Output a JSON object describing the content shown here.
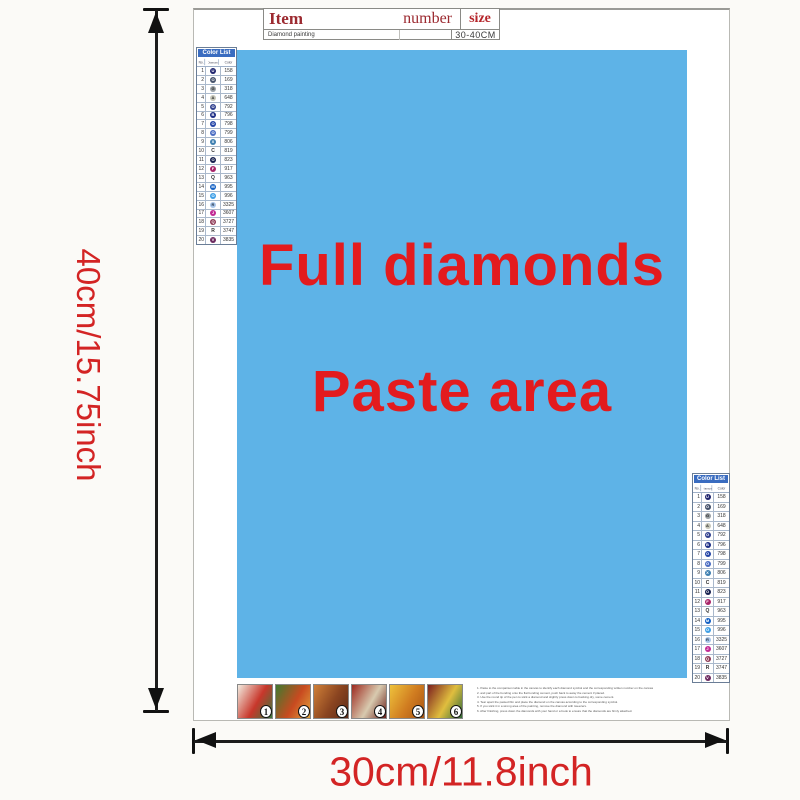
{
  "colors": {
    "paste_bg": "#5eb3e7",
    "paste_text": "#e31b1e",
    "dimension_text": "#d32424",
    "item_header_text": "#9c2a30",
    "color_list_header_bg": "#3a6cc0"
  },
  "dimension_labels": {
    "height": "40cm/15.75inch",
    "width": "30cm/11.8inch"
  },
  "item_table": {
    "col_item": "Item",
    "col_number": "number",
    "col_size": "size",
    "row_item": "Diamond painting",
    "row_number": "",
    "row_size": "30-40CM"
  },
  "paste_area": {
    "line1": "Full diamonds",
    "line2": "Paste area"
  },
  "color_list": {
    "title": "Color List",
    "columns": [
      "No.",
      "Diamond",
      "Color"
    ],
    "rows": [
      {
        "no": "1",
        "glyph": "U",
        "circle": "#20256e",
        "glyph_color": "#ffffff",
        "code": "158"
      },
      {
        "no": "2",
        "glyph": "O",
        "circle": "#45526b",
        "glyph_color": "#ffffff",
        "code": "169"
      },
      {
        "no": "3",
        "glyph": "G",
        "circle": "#9aa0a4",
        "glyph_color": "#222222",
        "code": "318"
      },
      {
        "no": "4",
        "glyph": "A",
        "circle": "#c6c6b8",
        "glyph_color": "#333333",
        "code": "648"
      },
      {
        "no": "5",
        "glyph": "O",
        "circle": "#31418f",
        "glyph_color": "#ffffff",
        "code": "792"
      },
      {
        "no": "6",
        "glyph": "B",
        "circle": "#1b2d85",
        "glyph_color": "#ffffff",
        "code": "796"
      },
      {
        "no": "7",
        "glyph": "O",
        "circle": "#2344a6",
        "glyph_color": "#ffffff",
        "code": "798"
      },
      {
        "no": "8",
        "glyph": "O",
        "circle": "#4a6cc2",
        "glyph_color": "#ffffff",
        "code": "799"
      },
      {
        "no": "9",
        "glyph": "X",
        "circle": "#3e7fb0",
        "glyph_color": "#ffffff",
        "code": "806"
      },
      {
        "no": "10",
        "glyph": "C",
        "circle": "",
        "glyph_color": "#333333",
        "code": "819"
      },
      {
        "no": "11",
        "glyph": "O",
        "circle": "#161f4e",
        "glyph_color": "#ffffff",
        "code": "823"
      },
      {
        "no": "12",
        "glyph": "F",
        "circle": "#a82468",
        "glyph_color": "#ffffff",
        "code": "917"
      },
      {
        "no": "13",
        "glyph": "Q",
        "circle": "",
        "glyph_color": "#333333",
        "code": "963"
      },
      {
        "no": "14",
        "glyph": "M",
        "circle": "#1360c4",
        "glyph_color": "#ffffff",
        "code": "995"
      },
      {
        "no": "15",
        "glyph": "O",
        "circle": "#3f9fe6",
        "glyph_color": "#ffffff",
        "code": "996"
      },
      {
        "no": "16",
        "glyph": "R",
        "circle": "#a9c6ea",
        "glyph_color": "#223344",
        "code": "3325"
      },
      {
        "no": "17",
        "glyph": "J",
        "circle": "#c22a94",
        "glyph_color": "#ffffff",
        "code": "3607"
      },
      {
        "no": "18",
        "glyph": "Q",
        "circle": "#8e3a56",
        "glyph_color": "#ffffff",
        "code": "3727"
      },
      {
        "no": "19",
        "glyph": "R",
        "circle": "",
        "glyph_color": "#333333",
        "code": "3747"
      },
      {
        "no": "20",
        "glyph": "V",
        "circle": "#6d2b60",
        "glyph_color": "#ffffff",
        "code": "3835"
      }
    ]
  },
  "steps": [
    {
      "num": "1",
      "tile_colors": [
        "#f2ece0",
        "#c8372b",
        "#3a7a3c"
      ]
    },
    {
      "num": "2",
      "tile_colors": [
        "#3f7a2f",
        "#c84a20",
        "#e0a23c"
      ]
    },
    {
      "num": "3",
      "tile_colors": [
        "#d08038",
        "#8a4420",
        "#5c2a18"
      ]
    },
    {
      "num": "4",
      "tile_colors": [
        "#9e2a20",
        "#d8caaf",
        "#6b1f1a"
      ]
    },
    {
      "num": "5",
      "tile_colors": [
        "#eec23c",
        "#d07c20",
        "#a85414"
      ]
    },
    {
      "num": "6",
      "tile_colors": [
        "#7c1f1f",
        "#e0be3e",
        "#2f6b38"
      ]
    }
  ],
  "instructions": {
    "lines": [
      "1. Paste to the comparison table in the canvas to identify each diamond symbol and the corresponding written number on the canvas",
      "2. and part of the bonding onto the flat bonding cement, push back to away the cement if placed.",
      "3. Use the round tip of the pen to stick a diamond and slightly press down to backing dry, some cement.",
      "4. Tear apart the pasted film and place the diamond on the canvas according to the corresponding symbol.",
      "5. If you stick it in a wrong area of the painting, remove the diamond with tweezers.",
      "6. After finishing, press down the diamonds with your hand or a book to ensure that the diamonds are firmly attached."
    ]
  }
}
